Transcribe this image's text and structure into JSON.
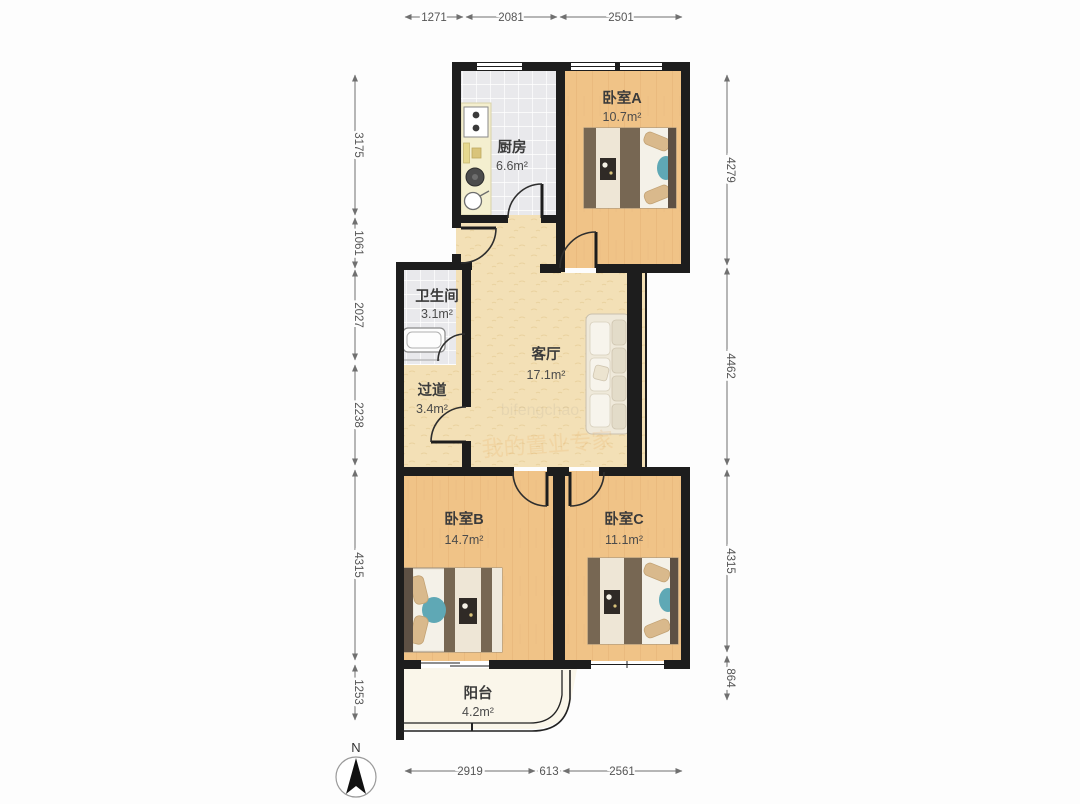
{
  "plan": {
    "rooms": [
      {
        "id": "kitchen",
        "name": "厨房",
        "area": "6.6m²"
      },
      {
        "id": "bedroomA",
        "name": "卧室A",
        "area": "10.7m²"
      },
      {
        "id": "bathroom",
        "name": "卫生间",
        "area": "3.1m²"
      },
      {
        "id": "living",
        "name": "客厅",
        "area": "17.1m²"
      },
      {
        "id": "hallway",
        "name": "过道",
        "area": "3.4m²"
      },
      {
        "id": "bedroomB",
        "name": "卧室B",
        "area": "14.7m²"
      },
      {
        "id": "bedroomC",
        "name": "卧室C",
        "area": "11.1m²"
      },
      {
        "id": "balcony",
        "name": "阳台",
        "area": "4.2m²"
      }
    ],
    "dimensions": {
      "top": [
        "1271",
        "2081",
        "2501"
      ],
      "bottom": [
        "2919",
        "613",
        "2561"
      ],
      "left": [
        "3175",
        "1061",
        "2027",
        "2238",
        "4315",
        "1253"
      ],
      "right": [
        "4279",
        "4462",
        "4315",
        "864"
      ]
    },
    "compass": {
      "label": "N"
    },
    "watermark": {
      "text": "我的置业专家"
    }
  },
  "colors": {
    "wall": "#1d1d1d",
    "wood_floor": "#f0c387",
    "tile_floor": "#e9e9ec",
    "living_floor": "#f3e0b6",
    "balcony_floor": "#faf6ea",
    "blanket_brown": "#776753",
    "pillow_tan": "#d9b98c",
    "cushion_teal": "#5fa8b5",
    "dim_gray": "#555555"
  }
}
